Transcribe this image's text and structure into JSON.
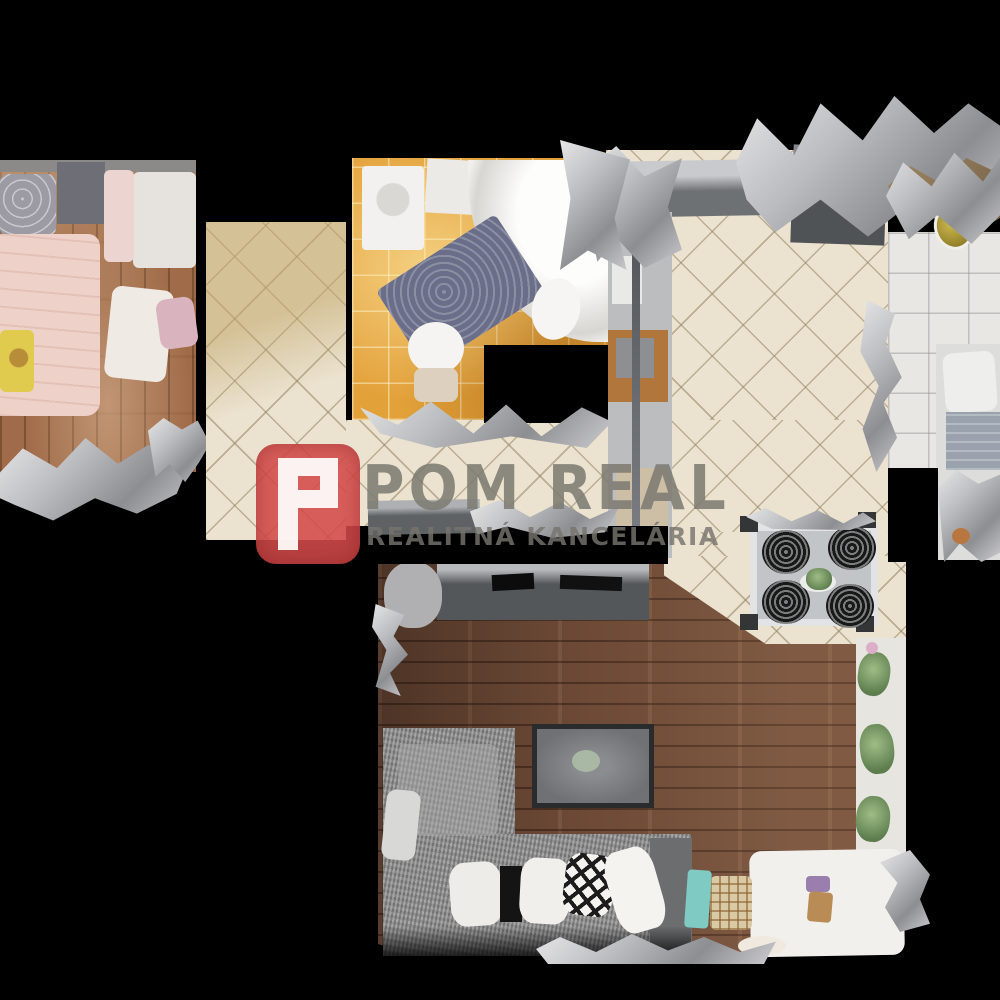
{
  "scene": {
    "type": "3d-dollhouse-floorplan-scan",
    "description": "Top-down 3D scan of an apartment used as a real-estate listing image",
    "background_color": "#000000"
  },
  "watermark": {
    "logo_letter": "P",
    "logo_color": "#d34a4a",
    "title": "POM REAL",
    "subtitle": "REALITNÁ KANCELÁRIA",
    "text_color": "#7d7b73"
  },
  "rooms": [
    {
      "name": "bedroom",
      "floor": "wood",
      "floor_color": "#a06b48",
      "items": [
        "pink-duvet-bed",
        "yellow-blanket",
        "gray-heart-pillow",
        "headboard-cushion",
        "white-linens"
      ]
    },
    {
      "name": "hallway",
      "floor": "beige-diamond-tile",
      "floor_color": "#ebe2cf"
    },
    {
      "name": "bathroom",
      "floor": "orange-tile",
      "floor_color": "#e3a139",
      "items": [
        "corner-bathtub",
        "washing-machine",
        "toilet",
        "sink",
        "blue-bath-mat"
      ]
    },
    {
      "name": "kitchen",
      "floor": "beige-diamond-tile",
      "floor_color": "#ebe2cf",
      "items": [
        "counter",
        "appliance-column",
        "oven",
        "fridge"
      ]
    },
    {
      "name": "second-room",
      "floor": "white-tile",
      "floor_color": "#e9e7e3",
      "items": [
        "bed",
        "yellow-bowl"
      ]
    },
    {
      "name": "living-room",
      "floor": "dark-wood",
      "floor_color": "#6b4835",
      "items": [
        "tv-cabinet",
        "ottoman",
        "sectional-sofa",
        "fur-pillows",
        "diamond-pillow",
        "dining-table",
        "woven-chairs",
        "window-sill-plants",
        "white-blanket",
        "basket"
      ]
    }
  ],
  "artifacts": {
    "scan_noise_color": "#bcbdc0",
    "note": "silver mesh fragments typical of 3D scans"
  }
}
